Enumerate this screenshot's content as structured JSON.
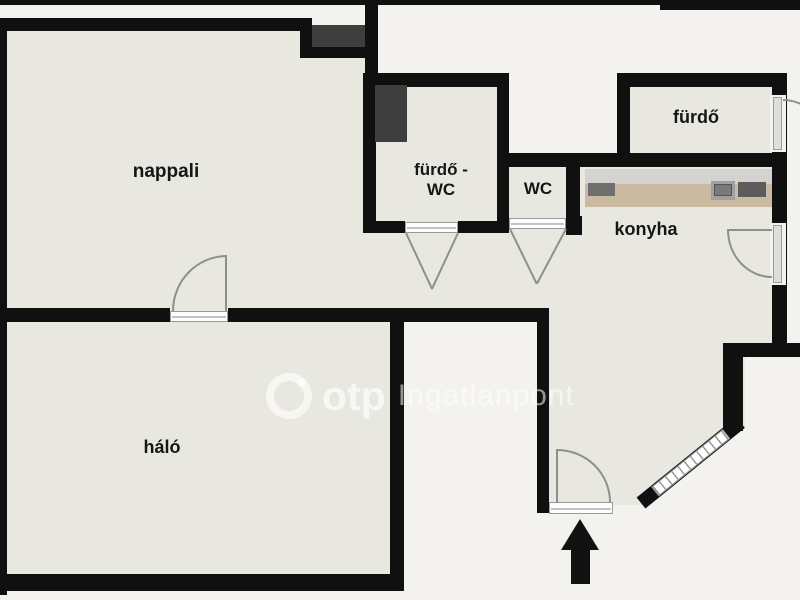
{
  "document": {
    "type": "apartment floor plan",
    "language": "Hungarian"
  },
  "rooms": {
    "nappali": {
      "label": "nappali"
    },
    "furdo_wc": {
      "label_line1": "fürdő -",
      "label_line2": "WC"
    },
    "wc": {
      "label": "WC"
    },
    "konyha": {
      "label": "konyha"
    },
    "furdo": {
      "label": "fürdő"
    },
    "halo": {
      "label": "háló"
    }
  },
  "watermark": {
    "brand": "otp",
    "suffix": "Ingatlanpont"
  },
  "colors": {
    "background": "#f3f2ee",
    "room_fill": "#e9e8e0",
    "wall": "#101010",
    "dark_object": "#3e3e3e",
    "counter_top": "#c9baa1",
    "counter_back": "#d4d3cf",
    "appliance": "#5c5c5c",
    "door_line": "#8f8f8f",
    "watermark_text": "rgba(255,255,255,0.6)"
  }
}
